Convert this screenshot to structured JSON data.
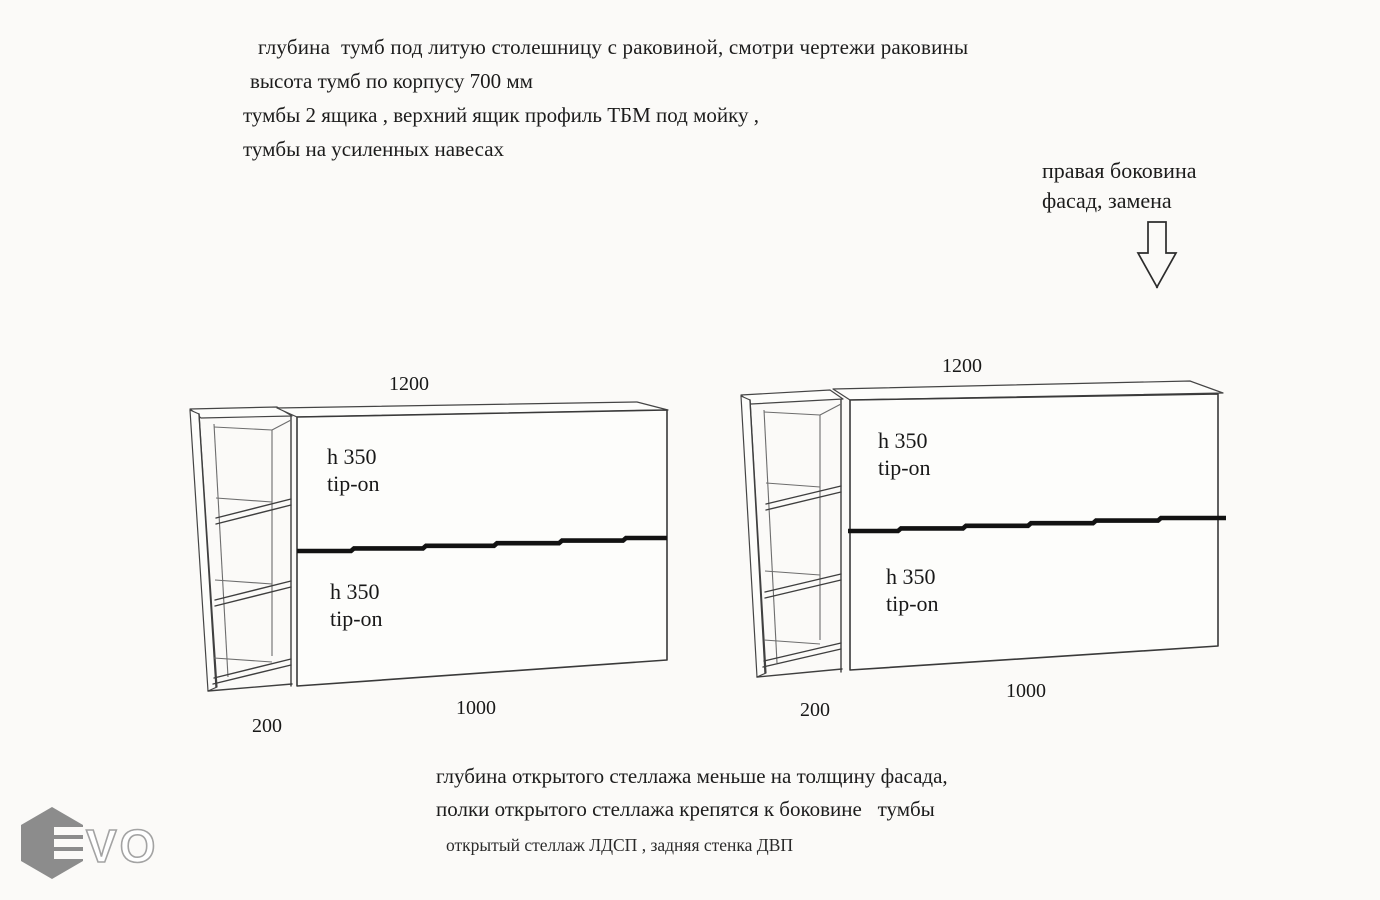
{
  "title_notes": {
    "line1": "глубина  тумб под литую столешницу с раковиной, смотри чертежи раковины",
    "line2": "высота тумб по корпусу 700 мм",
    "line3": "тумбы 2 ящика , верхний ящик профиль ТБМ под мойку ,",
    "line4": "тумбы на усиленных навесах"
  },
  "callout": {
    "line1": "правая боковина",
    "line2": "фасад, замена",
    "arrow_icon": "down-arrow"
  },
  "drawing": {
    "left_cabinet": {
      "top_width": "1200",
      "drawer1_height": "h 350",
      "drawer1_mech": "tip-on",
      "drawer2_height": "h 350",
      "drawer2_mech": "tip-on",
      "drawer_width": "1000",
      "shelf_width": "200"
    },
    "right_cabinet": {
      "top_width": "1200",
      "drawer1_height": "h 350",
      "drawer1_mech": "tip-on",
      "drawer2_height": "h 350",
      "drawer2_mech": "tip-on",
      "drawer_width": "1000",
      "shelf_width": "200"
    }
  },
  "footer_notes": {
    "line1": "глубина открытого стеллажа меньше на толщину фасада,",
    "line2": "полки открытого стеллажа крепятся к боковине   тумбы",
    "line3": "открытый стеллаж ЛДСП , задняя стенка ДВП"
  },
  "logo": {
    "text": "VO",
    "hex_color": "#8c8c8c"
  },
  "colors": {
    "background": "#fbfaf8",
    "line": "#3f3f3f",
    "divider": "#121212",
    "text": "#1c1c1c"
  }
}
